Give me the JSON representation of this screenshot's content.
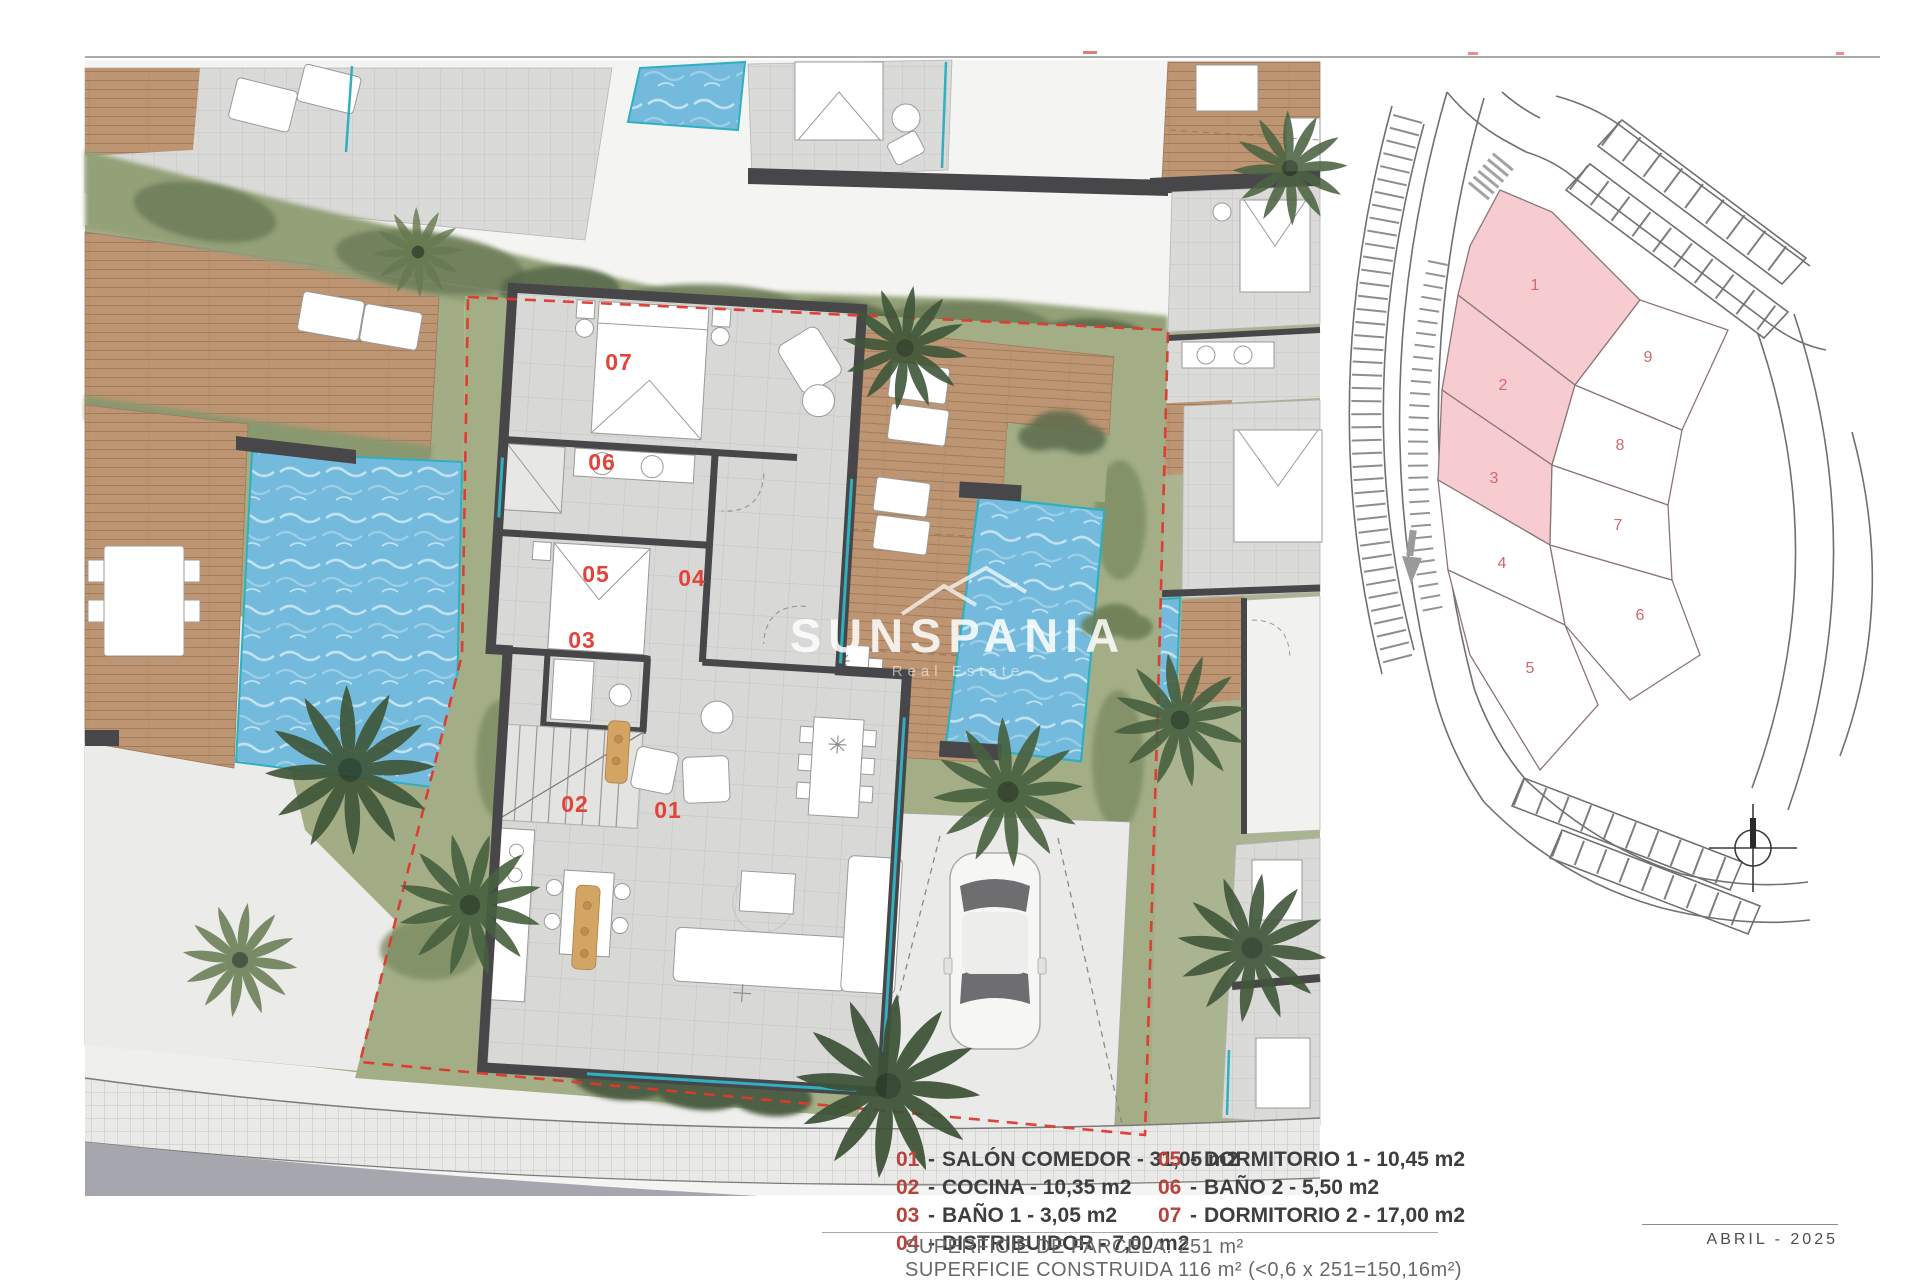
{
  "watermark": {
    "brand": "SUNSPANIA",
    "tagline": "Real Estate"
  },
  "plan": {
    "room_labels": [
      "01",
      "02",
      "03",
      "04",
      "05",
      "06",
      "07"
    ]
  },
  "site_map": {
    "plot_labels": [
      "1",
      "2",
      "3",
      "4",
      "5",
      "6",
      "7",
      "8",
      "9"
    ],
    "highlighted_plots": [
      "1",
      "2",
      "3"
    ],
    "highlight_color": "#f7ccd0"
  },
  "legend": {
    "separator": "-",
    "items": [
      {
        "num": "01",
        "text": "SALÓN COMEDOR - 31,05 m2"
      },
      {
        "num": "02",
        "text": "COCINA - 10,35 m2"
      },
      {
        "num": "03",
        "text": "BAÑO 1 - 3,05 m2"
      },
      {
        "num": "04",
        "text": "DISTRIBUIDOR - 7,00 m2"
      },
      {
        "num": "05",
        "text": "DORMITORIO 1 - 10,45 m2"
      },
      {
        "num": "06",
        "text": "BAÑO 2 - 5,50 m2"
      },
      {
        "num": "07",
        "text": "DORMITORIO 2 - 17,00 m2"
      }
    ]
  },
  "surface": {
    "line1": "SUPERFICIE DE PARCELA: 251 m²",
    "line2": "SUPERFICIE CONSTRUIDA 116 m² (<0,6 x 251=150,16m²)"
  },
  "footer": {
    "date": "ABRIL - 2025"
  },
  "colors": {
    "boundary_red": "#e0382e",
    "room_label_red": "#e0443a",
    "legend_num_red": "#b8433c",
    "pool_blue": "#74badc",
    "glass_teal": "#2fb0c0",
    "wood_deck": "#bd9572",
    "wall_dark": "#474749"
  }
}
